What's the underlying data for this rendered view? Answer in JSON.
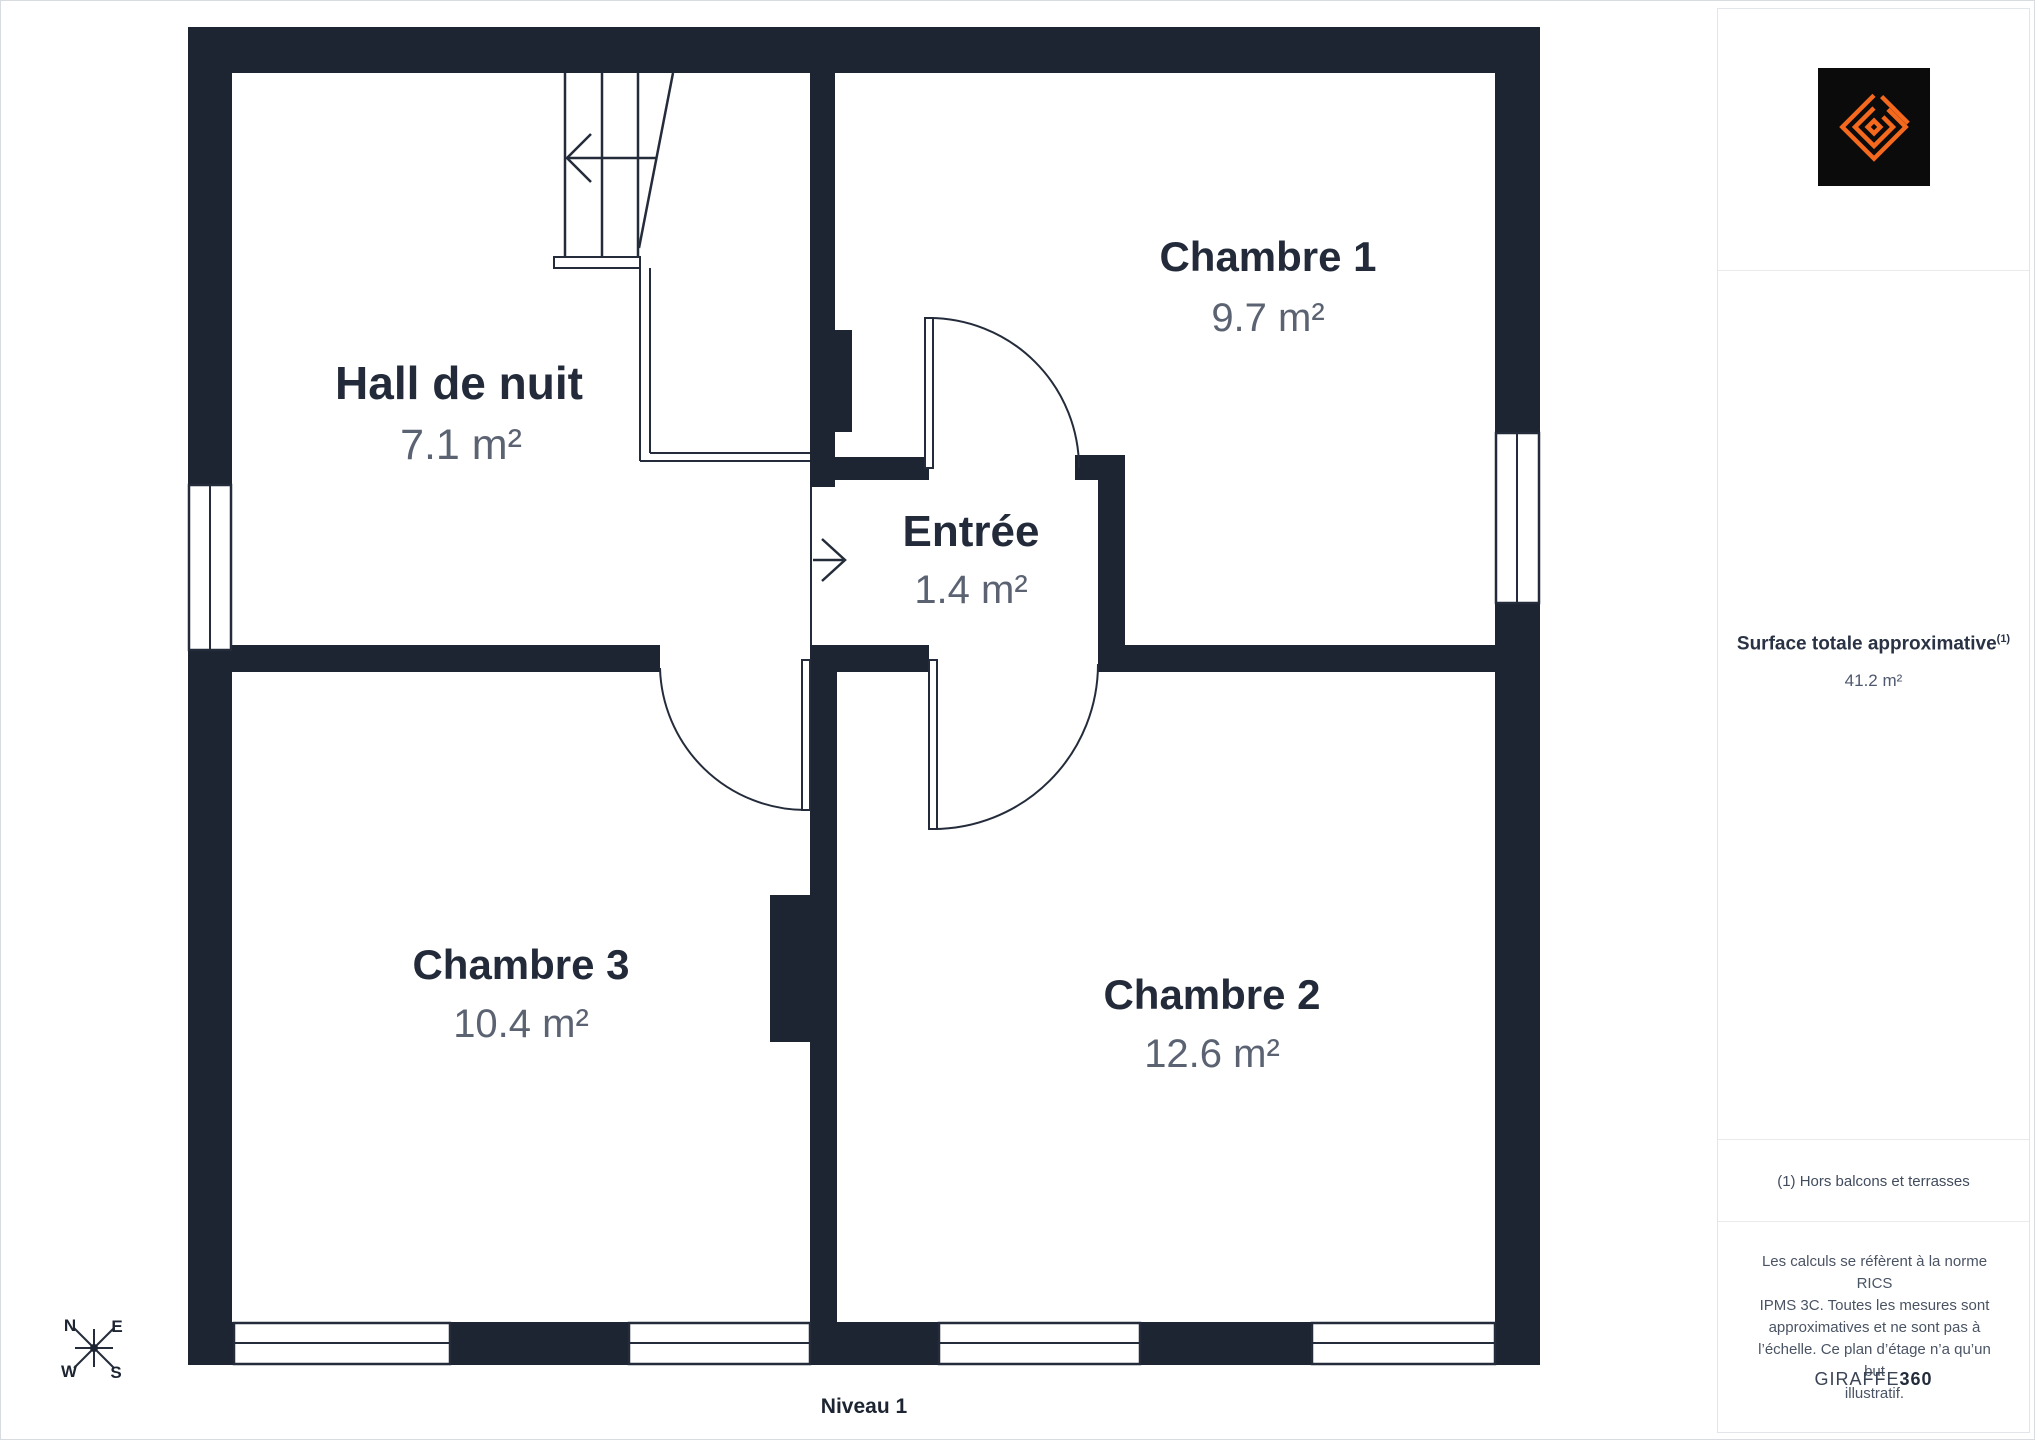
{
  "floor_plan": {
    "level_label": "Niveau 1",
    "rooms": [
      {
        "name": "Hall de nuit",
        "area": "7.1 m²"
      },
      {
        "name": "Chambre 1",
        "area": "9.7 m²"
      },
      {
        "name": "Entrée",
        "area": "1.4 m²"
      },
      {
        "name": "Chambre 3",
        "area": "10.4 m²"
      },
      {
        "name": "Chambre 2",
        "area": "12.6 m²"
      }
    ],
    "compass": {
      "north": "N",
      "east": "E",
      "south": "S",
      "west": "W"
    }
  },
  "sidebar": {
    "surface_label": "Surface totale approximative",
    "surface_label_sup": "(1)",
    "surface_value": "41.2 m²",
    "footnote": "(1) Hors balcons et terrasses",
    "legal_lines": [
      "Les calculs se réfèrent à la norme RICS",
      "IPMS 3C. Toutes les mesures sont",
      "approximatives et ne sont pas à",
      "l’échelle. Ce plan d’étage n’a qu’un but",
      "illustratif."
    ],
    "brand_name": "GIRAFFE",
    "brand_suffix": "360"
  },
  "colors": {
    "wall": "#1d2432",
    "room_label": "#232b3a",
    "area_label": "#5b6372",
    "accent_orange": "#f4691e",
    "logo_background": "#0b0b0b"
  }
}
